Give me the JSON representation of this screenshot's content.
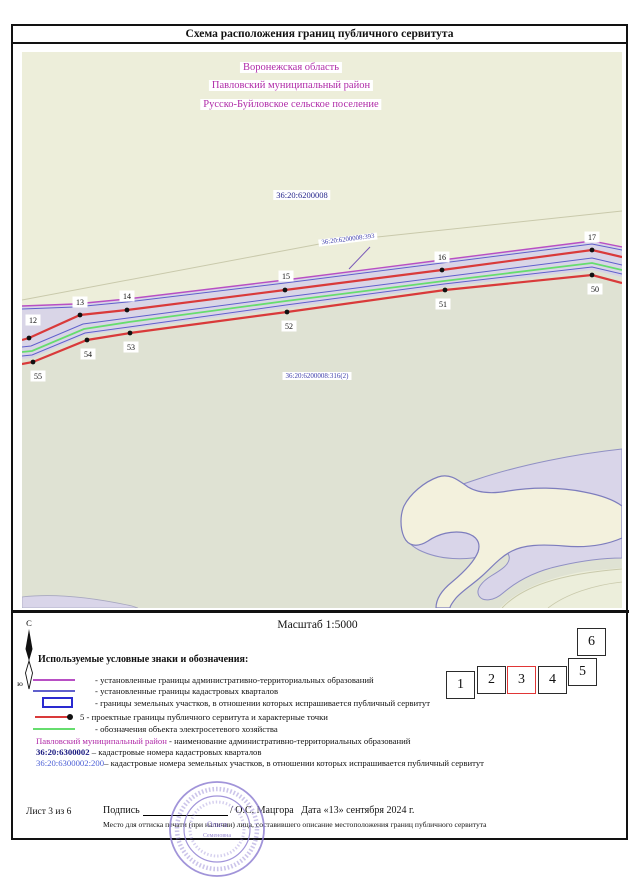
{
  "title": "Схема расположения границ публичного сервитута",
  "map": {
    "region_labels": [
      "Воронежская область",
      "Павловский муниципальный район",
      "Русско-Буйловское сельское поселение"
    ],
    "cadastral_quarter_label": "36:20:6200008",
    "parcel_label_393": "36:20:6200008:393",
    "parcel_label_316": "36:20:6200008:316(2)",
    "points_top": [
      {
        "label": "12",
        "x": 29,
        "y": 338,
        "lx": 33,
        "ly": 320
      },
      {
        "label": "13",
        "x": 80,
        "y": 315,
        "lx": 80,
        "ly": 302
      },
      {
        "label": "14",
        "x": 127,
        "y": 310,
        "lx": 127,
        "ly": 296
      },
      {
        "label": "15",
        "x": 285,
        "y": 290,
        "lx": 286,
        "ly": 276
      },
      {
        "label": "16",
        "x": 442,
        "y": 270,
        "lx": 442,
        "ly": 257
      },
      {
        "label": "17",
        "x": 592,
        "y": 250,
        "lx": 592,
        "ly": 237
      }
    ],
    "points_bottom": [
      {
        "label": "55",
        "x": 33,
        "y": 362,
        "lx": 38,
        "ly": 376
      },
      {
        "label": "54",
        "x": 87,
        "y": 340,
        "lx": 88,
        "ly": 354
      },
      {
        "label": "53",
        "x": 130,
        "y": 333,
        "lx": 131,
        "ly": 347
      },
      {
        "label": "52",
        "x": 287,
        "y": 312,
        "lx": 289,
        "ly": 326
      },
      {
        "label": "51",
        "x": 445,
        "y": 290,
        "lx": 443,
        "ly": 304
      },
      {
        "label": "50",
        "x": 592,
        "y": 275,
        "lx": 595,
        "ly": 289
      }
    ],
    "geometry": {
      "faint_line": [
        [
          22,
          300
        ],
        [
          330,
          242
        ],
        [
          622,
          211
        ]
      ],
      "band_top": [
        [
          22,
          306
        ],
        [
          75,
          304
        ],
        [
          127,
          299
        ],
        [
          285,
          280
        ],
        [
          442,
          260
        ],
        [
          592,
          241
        ],
        [
          622,
          247
        ]
      ],
      "band_top2": [
        [
          22,
          309
        ],
        [
          75,
          307
        ],
        [
          127,
          302
        ],
        [
          285,
          283
        ],
        [
          442,
          263
        ],
        [
          592,
          244
        ],
        [
          622,
          250
        ]
      ],
      "band_bottom": [
        [
          22,
          359
        ],
        [
          32,
          358
        ],
        [
          85,
          335
        ],
        [
          129,
          329
        ],
        [
          286,
          308
        ],
        [
          444,
          287
        ],
        [
          592,
          270
        ],
        [
          622,
          277
        ]
      ],
      "blue_mid1": [
        [
          22,
          347
        ],
        [
          31,
          346
        ],
        [
          83,
          324
        ],
        [
          128,
          318
        ],
        [
          286,
          297
        ],
        [
          443,
          277
        ],
        [
          592,
          258
        ],
        [
          622,
          265
        ]
      ],
      "green_power": [
        [
          22,
          352
        ],
        [
          32,
          351
        ],
        [
          84,
          329
        ],
        [
          129,
          322
        ],
        [
          286,
          301
        ],
        [
          444,
          281
        ],
        [
          592,
          263
        ],
        [
          622,
          270
        ]
      ],
      "blue_mid2": [
        [
          22,
          356
        ],
        [
          32,
          355
        ],
        [
          85,
          333
        ],
        [
          129,
          327
        ],
        [
          286,
          305
        ],
        [
          444,
          284
        ],
        [
          592,
          267
        ],
        [
          622,
          274
        ]
      ],
      "red_top": [
        [
          22,
          340
        ],
        [
          29,
          338
        ],
        [
          80,
          315
        ],
        [
          127,
          310
        ],
        [
          285,
          290
        ],
        [
          442,
          270
        ],
        [
          592,
          250
        ],
        [
          622,
          257
        ]
      ],
      "red_bottom": [
        [
          22,
          364
        ],
        [
          33,
          362
        ],
        [
          87,
          340
        ],
        [
          130,
          333
        ],
        [
          287,
          312
        ],
        [
          445,
          290
        ],
        [
          592,
          275
        ],
        [
          622,
          283
        ]
      ],
      "leader_393": [
        [
          370,
          247
        ],
        [
          349,
          269
        ]
      ],
      "bl_wedge": "M22,597 C55,593 95,598 132,606 L138,608 L22,608 Z",
      "br_lavender": "M622,449 C575,454 520,465 478,479 C448,489 418,499 407,512 C397,525 402,541 419,550 C439,560 466,561 487,555 C499,551 507,549 509,556 C511,564 501,570 491,576 C483,581 475,589 479,596 C483,602 494,601 503,593 C517,581 536,571 559,566 C585,560 606,558 622,558 Z",
      "duck": "M404,506 C410,494 424,482 438,477 C450,473 458,480 468,487 C478,493 492,494 508,491 C532,487 560,487 584,492 C600,495 614,500 622,506 L622,538 C606,545 586,548 564,546 C540,544 524,545 512,551 C500,557 492,567 482,576 C472,585 462,591 456,598 C452,603 450,606 450,608 L436,608 C436,599 442,590 452,582 C464,572 474,562 478,552 C481,543 477,536 466,533 C452,530 438,534 428,541 C417,548 408,546 404,537 C400,528 400,515 404,506 Z",
      "corner_cream": "M500,608 C518,589 552,576 588,571 L622,568 L622,608 Z",
      "corner_curve1": "M502,608 C522,587 558,574 622,569",
      "corner_curve2": "M548,608 C566,594 594,585 622,582"
    }
  },
  "scale_text": "Масштаб 1:5000",
  "north_arrow": {
    "north_label": "С",
    "south_label": "ю"
  },
  "legend": {
    "heading": "Используемые условные знаки и обозначения:",
    "items": [
      {
        "label": "- установленные границы административно-территориальных образований"
      },
      {
        "label": "- установленные границы кадастровых кварталов"
      },
      {
        "label": "- границы земельных участков, в отношении которых испрашивается публичный сервитут"
      },
      {
        "label": "5 - проектные границы публичного сервитута и характерные точки"
      },
      {
        "label": "- обозначения объекта электросетевого хозяйства"
      }
    ],
    "text_items": [
      {
        "term": "Павловский муниципальный район",
        "rest": " - наименование административно-территориальных образований"
      },
      {
        "term": "36:20:6300002",
        "rest": " – кадастровые номера кадастровых кварталов"
      },
      {
        "term": "36:20:6300002:200",
        "rest": "– кадастровые номера земельных участков, в отношении которых испрашивается публичный сервитут"
      }
    ]
  },
  "sheet_index": {
    "squares": [
      "1",
      "2",
      "3",
      "4",
      "5",
      "6"
    ],
    "current": "3"
  },
  "footer": {
    "sheet_label": "Лист 3 из 6",
    "signature_label": "Подпись",
    "signature_name": "/ О.С. Мацгора   Дата «13» сентября 2024 г.",
    "stamp_note": "Место для оттиска печати (при наличии) лица, составившего описание местоположения границ публичного сервитута"
  },
  "stamp": {
    "line1": "Ольга",
    "line2": "Семеновна"
  },
  "colors": {
    "map_upper": "#edeeda",
    "map_lower": "#dfe2d3",
    "lavender": "#d9d5e9",
    "band": "#d6d2e8",
    "cream": "#f3f1dd",
    "corner": "#eceedb",
    "blob_outline": "#7d7dbd",
    "admin_boundary": "#b84fc4",
    "quarter_boundary": "#6060cc",
    "parcel_border": "#2a2ad0",
    "servitude": "#d93a3a",
    "power_line": "#66dd6e",
    "faint": "#c9c9ab"
  }
}
